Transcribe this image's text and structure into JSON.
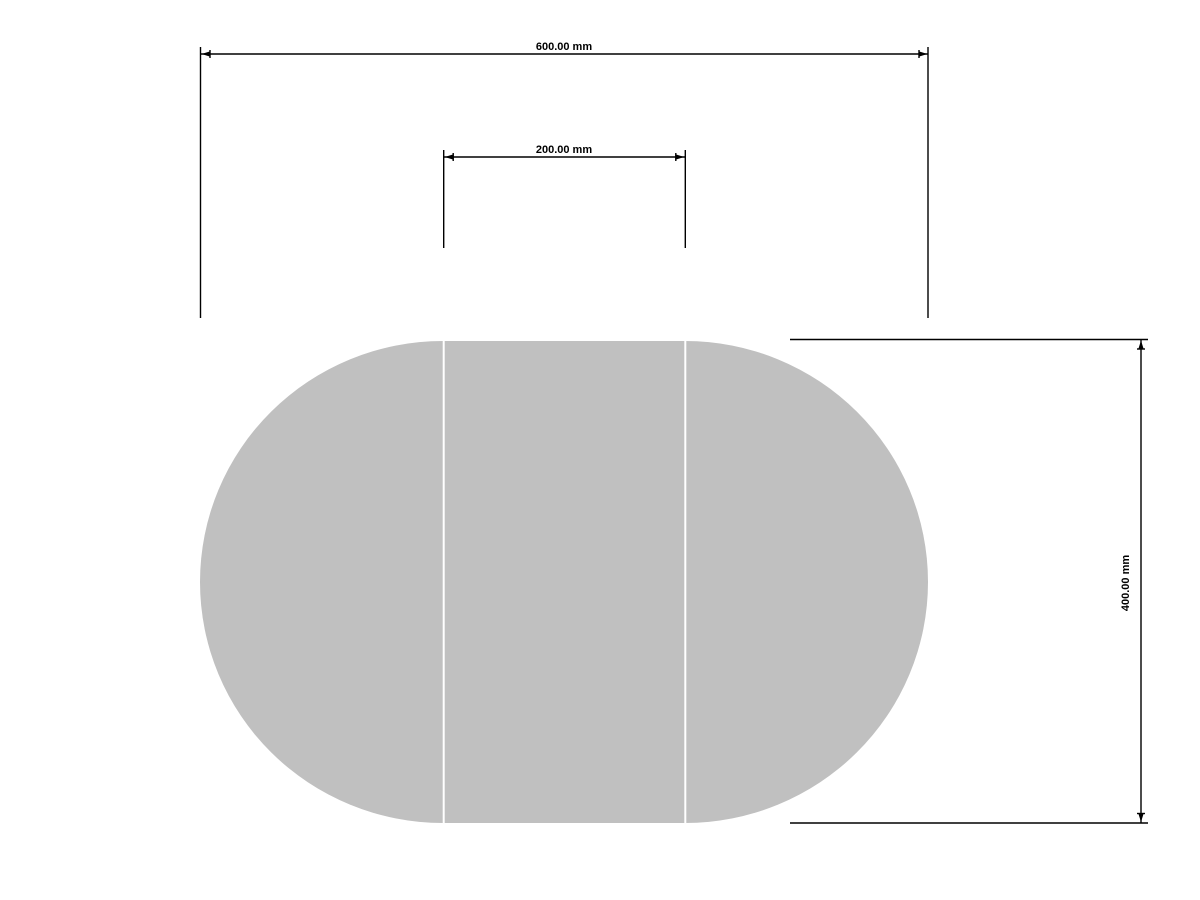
{
  "app": {
    "background_color": "#ffffff"
  },
  "drawing": {
    "line_color": "#000000",
    "text_color": "#000000",
    "shape": {
      "fill_color": "#c0c0c0",
      "divider_color": "#ffffff"
    },
    "dimensions": {
      "total_width": {
        "label": "600.00 mm",
        "orientation": "horizontal"
      },
      "center_width": {
        "label": "200.00 mm",
        "orientation": "horizontal"
      },
      "height": {
        "label": "400.00 mm",
        "orientation": "vertical"
      }
    }
  }
}
